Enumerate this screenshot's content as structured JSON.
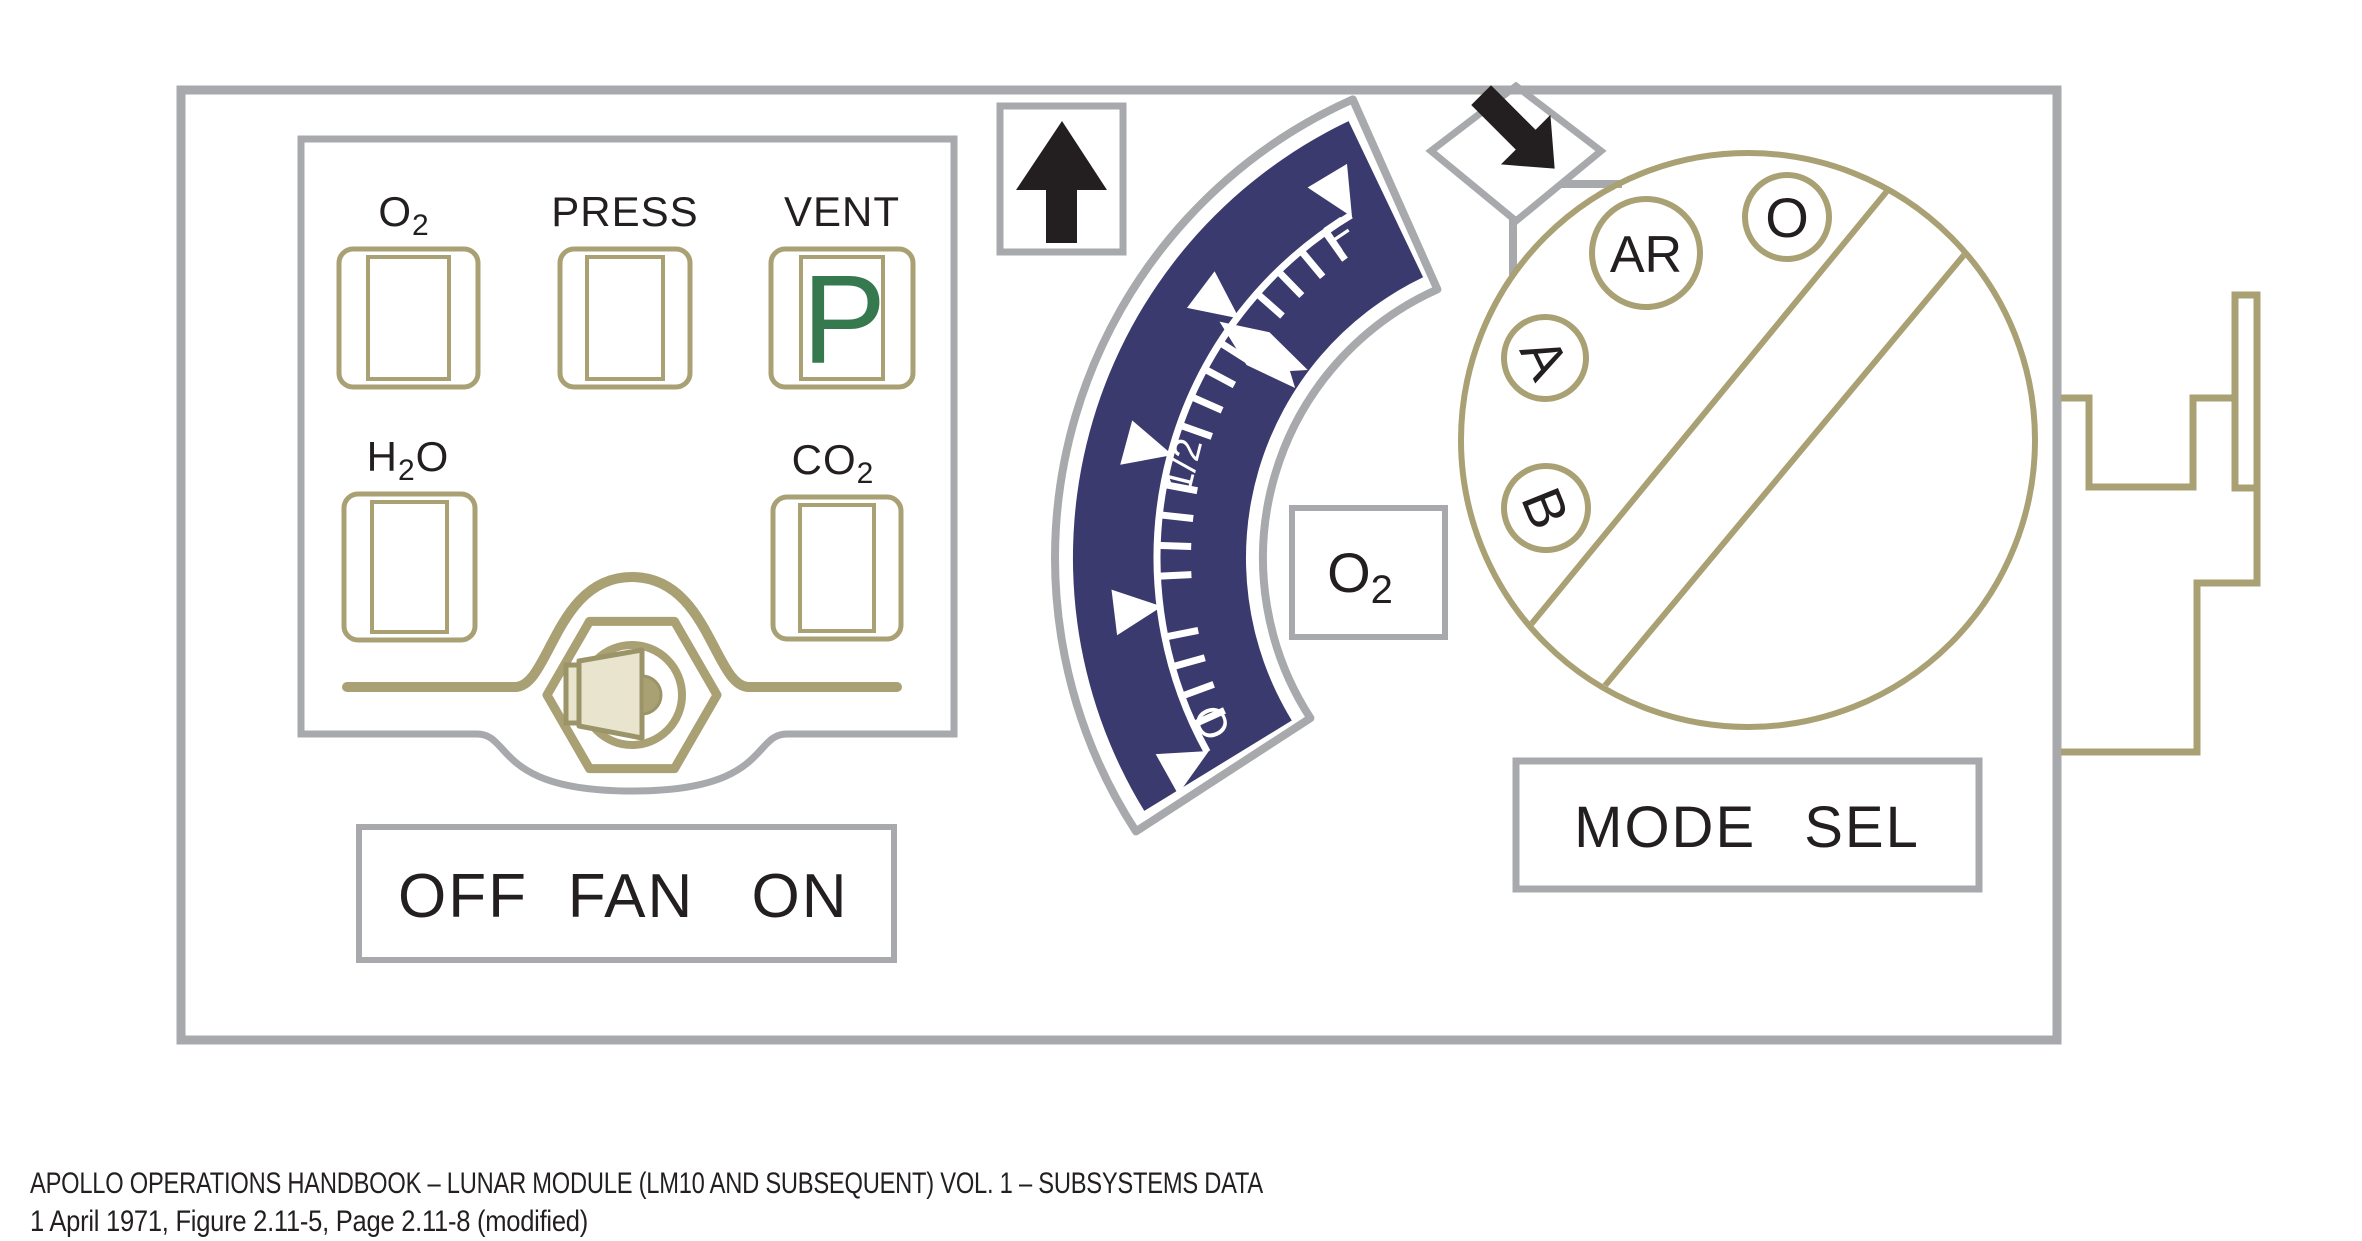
{
  "figure": {
    "title_context": "LM Environmental Control panel drawing",
    "colors": {
      "navy_band": "#3b3a6e",
      "olive_line": "#a9a174",
      "olive_dark": "#9a9468",
      "panel_gray": "#a7a9ac",
      "ink_black": "#231f20",
      "indicator_green": "#37794e",
      "knob_beige": "#e8e4ce",
      "background": "#ffffff"
    }
  },
  "lamps": {
    "o2": {
      "base": "O",
      "sub": "2"
    },
    "press": {
      "label": "PRESS"
    },
    "vent": {
      "label": "VENT",
      "indicator": "P"
    },
    "h2o": {
      "p1": "H",
      "sub": "2",
      "p2": "O"
    },
    "co2": {
      "base": "CO",
      "sub": "2"
    }
  },
  "fan_switch": {
    "off": "OFF",
    "fan": "FAN",
    "on": "ON"
  },
  "gauge": {
    "type": "arc-quantity-gauge",
    "full": "F",
    "half": "1/2",
    "empty": "O",
    "gas": {
      "base": "O",
      "sub": "2"
    },
    "needle_position_fraction": 0.72,
    "major_marks": [
      "O",
      "1/4",
      "1/2",
      "3/4",
      "F"
    ],
    "minor_ticks_between_majors": 4
  },
  "mode_selector": {
    "label": "MODE SEL",
    "positions": {
      "b": "B",
      "a": "A",
      "ar": "AR",
      "o": "O"
    }
  },
  "caption": {
    "line1": "APOLLO OPERATIONS HANDBOOK – LUNAR MODULE (LM10 AND SUBSEQUENT) VOL. 1 – SUBSYSTEMS DATA",
    "line2": "1 April 1971, Figure 2.11-5, Page 2.11-8 (modified)"
  }
}
